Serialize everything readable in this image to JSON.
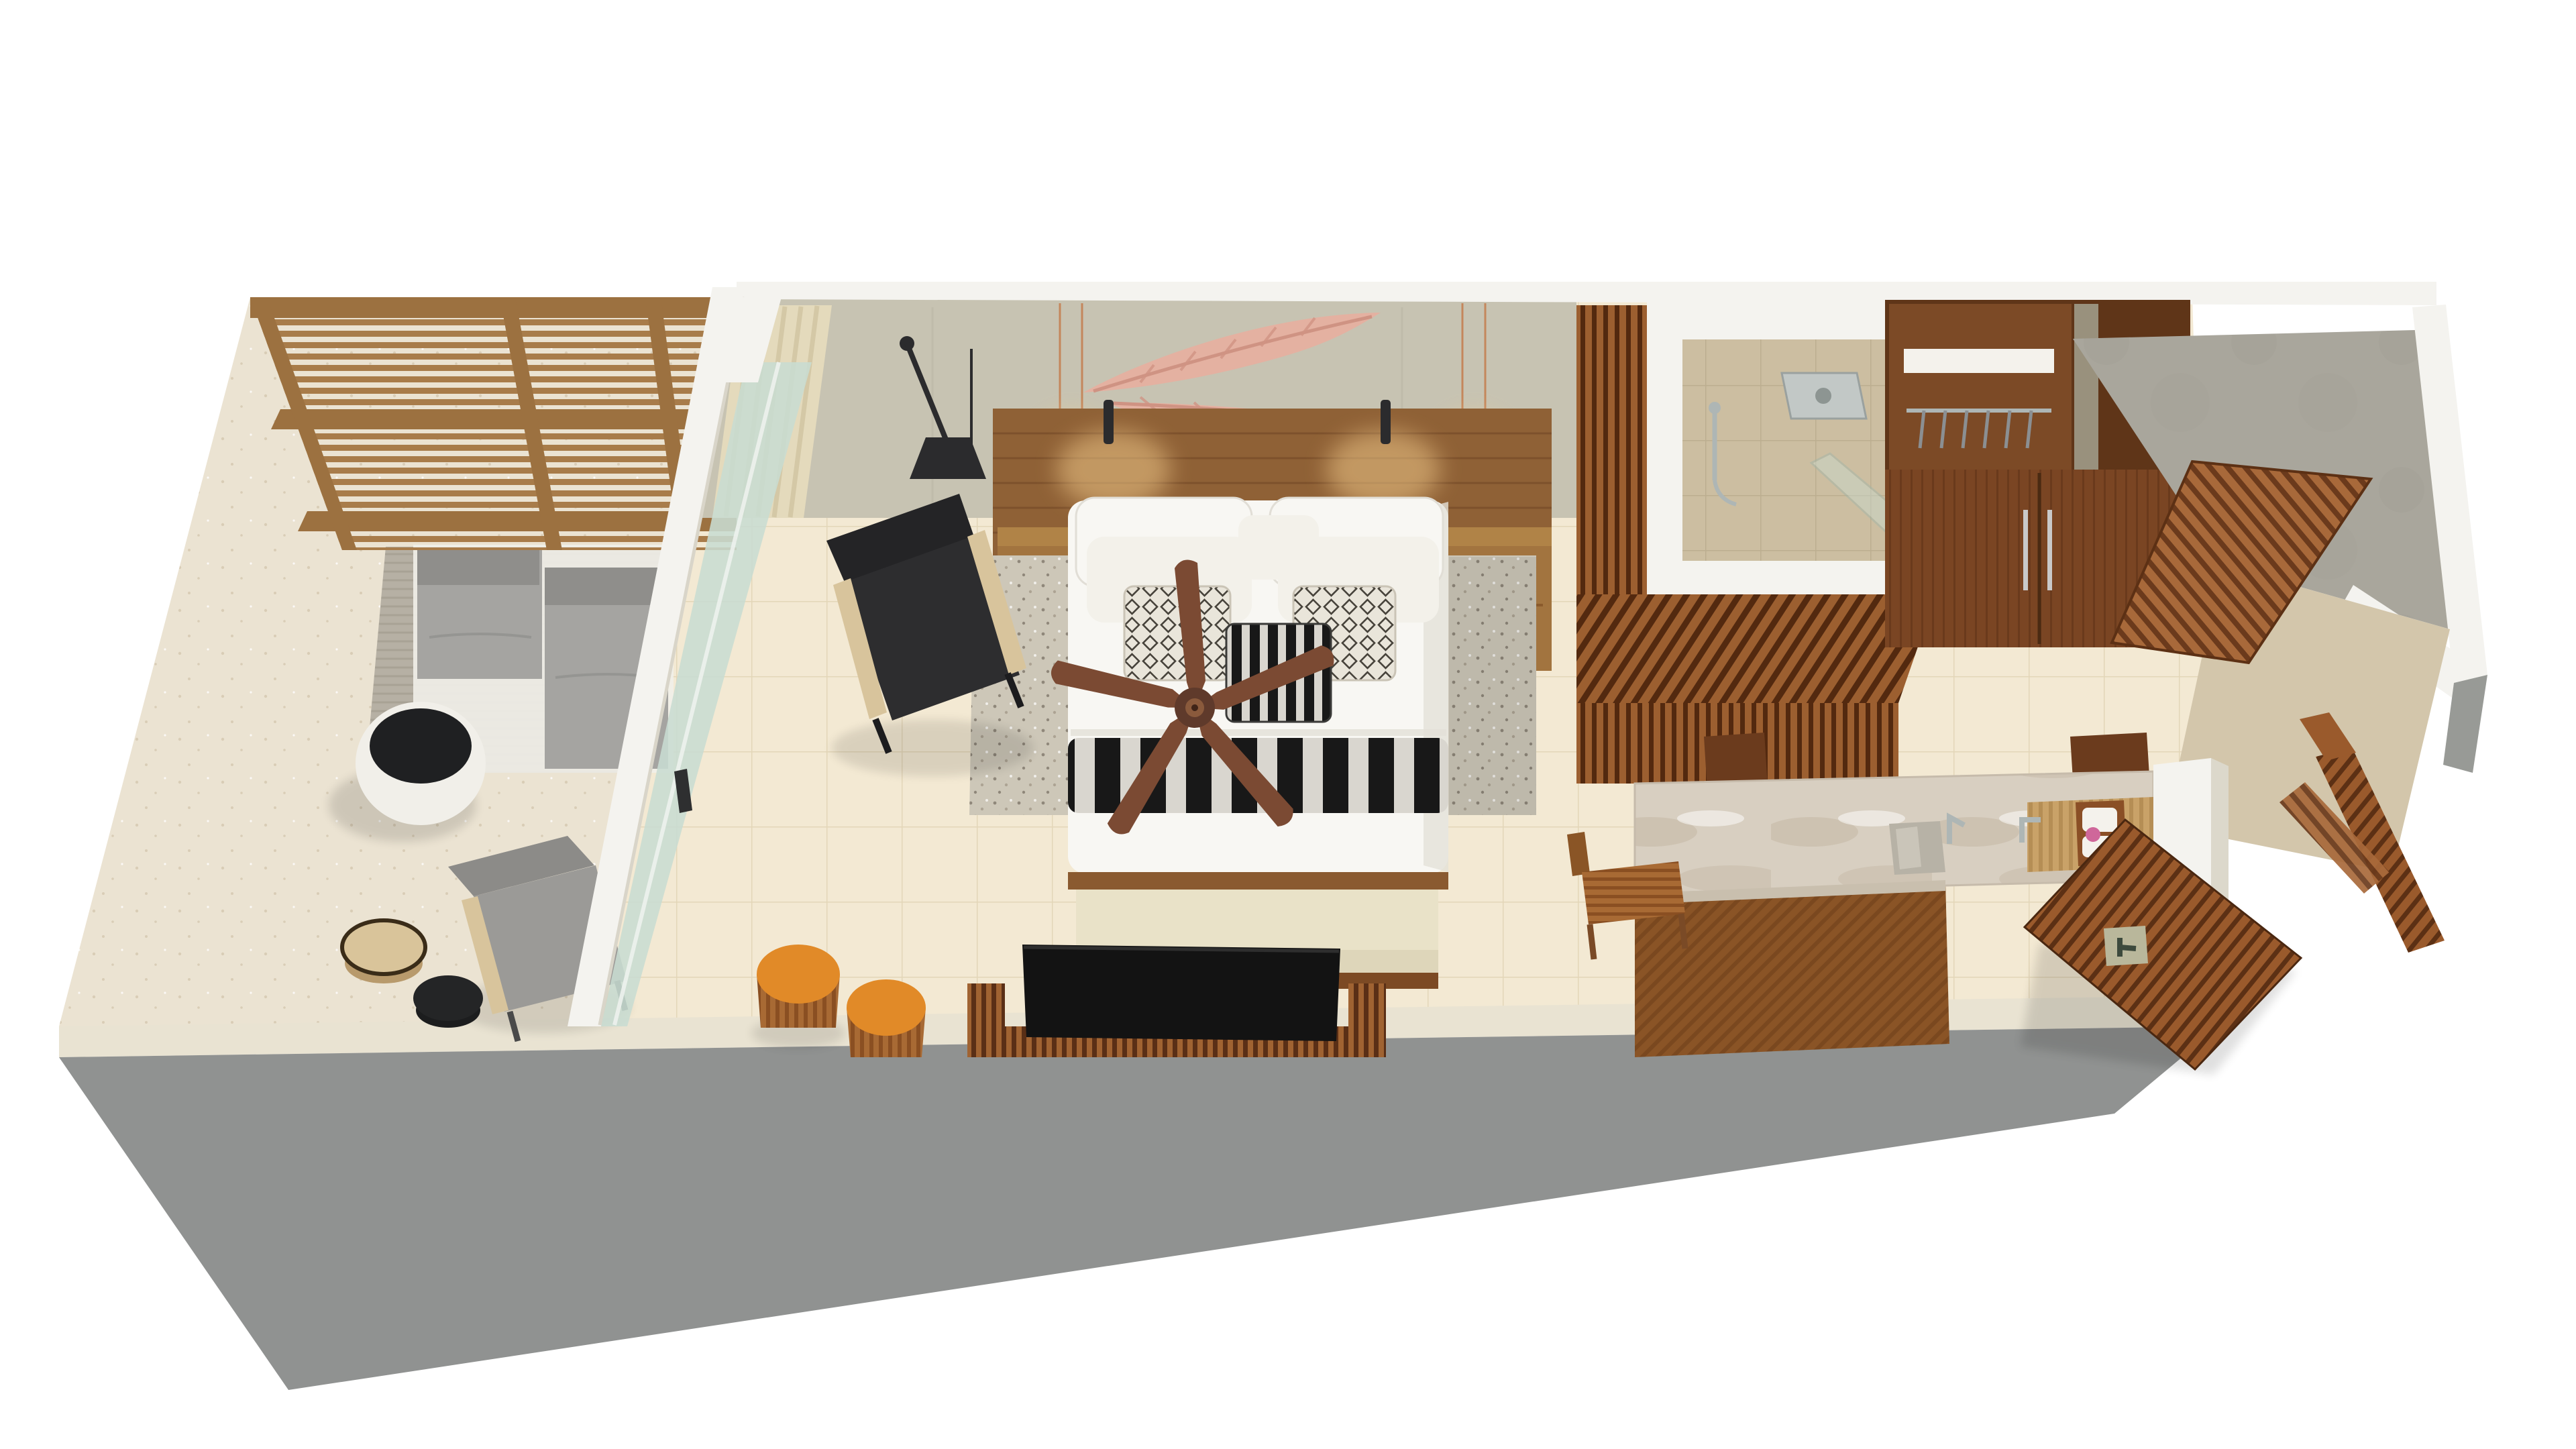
{
  "scene": {
    "kind": "isometric-3d-floor-plan-render",
    "rooms": {
      "terrace": [
        "pergola-roof",
        "lounge-daybed",
        "terrace-rug",
        "round-planter-table",
        "outdoor-armchair",
        "side-table-wood",
        "side-table-black",
        "sliding-glass-door"
      ],
      "bedroom": [
        "feather-wall-art",
        "swing-arm-wall-lamp",
        "curtain",
        "wood-headboard",
        "nightstand-left",
        "nightstand-right",
        "wall-sconces",
        "copper-pendant-lights",
        "double-bed",
        "patterned-cushions",
        "striped-throw",
        "foot-bench",
        "area-rug",
        "ceiling-fan",
        "lounge-chair",
        "orange-drum-stools",
        "tv",
        "tv-console"
      ],
      "bathroom": [
        "wood-slat-partition",
        "walk-in-shower",
        "rain-shower-head",
        "hand-shower",
        "glass-screen",
        "wardrobe",
        "walk-in-closet",
        "clothes-rail-with-hangers",
        "vanity-counter",
        "marble-countertop",
        "vessel-sink",
        "faucet",
        "towel-tray",
        "teak-stool",
        "wood-cabinets"
      ],
      "entry": [
        "concrete-patio",
        "wood-slat-screen",
        "entry-door",
        "door-handle",
        "wood-beam",
        "tan-floor"
      ]
    }
  },
  "colors": {
    "page_bg": "#ffffff",
    "outer_wall_gray": "#909291",
    "outer_wall_gray2": "#989a96",
    "outer_wall_top": "#e9e3d2",
    "terrace_floor": "#ebe3d2",
    "terrace_speck": "#d9cdb6",
    "terrace_rug": "#b6b0a4",
    "terrace_rug_line": "#a8a295",
    "daybed_gray": "#a5a4a1",
    "daybed_dark": "#8f8e8b",
    "planter_white": "#f1efe9",
    "planter_top": "#1f2022",
    "armchair_gray": "#9b9a97",
    "armchair_back": "#8c8b88",
    "side_table_wood": "#d9c49a",
    "side_table_wood_dark": "#b89a6c",
    "side_table_black": "#242526",
    "pergola_wood": "#a87c4a",
    "pergola_beam": "#9c7140",
    "wall_white": "#f4f3ef",
    "wall_shadow": "#d9d5c9",
    "glass_green": "#c8dcd1",
    "glass_line": "#eef2ee",
    "bedroom_wall": "#c7c3b2",
    "wall_seam": "#bdb8a8",
    "art_pink": "#e4b1a1",
    "art_pink_dark": "#cf9383",
    "lamp_black": "#2b2b2d",
    "curtain_cream": "#e4dabc",
    "curtain_shade": "#cfc3a0",
    "headboard_wood": "#8f6136",
    "headboard_line": "#7a4f2a",
    "nightstand_wood": "#a2743f",
    "nightstand_top": "#b08347",
    "pendant_copper": "#c4875c",
    "glow_warm": "#f6cf8e",
    "bed_white": "#f8f7f3",
    "bed_shadow": "#e4e1d8",
    "pillow_white": "#f3f1ea",
    "cushion_bg": "#e9e5da",
    "cushion_fg": "#46423a",
    "stripe_black": "#181818",
    "stripe_light": "#d9d6cf",
    "bench_cream": "#e9e2c8",
    "bench_front": "#ded6ba",
    "bench_wood": "#7c4a24",
    "rug_base": "#cdc7b8",
    "rug_dot": "#8f877a",
    "rug_dot2": "#aca393",
    "fan_wood": "#7b4a33",
    "fan_edge": "#5f3a28",
    "fan_hub": "#5f3a2b",
    "fan_hub2": "#8a5a3c",
    "chair_black": "#2d2d2f",
    "chair_back": "#242426",
    "chair_arm_wood": "#d8c49c",
    "stool_orange": "#e18a28",
    "stool_rim": "#b5651d",
    "stool_wood": "#a86a34",
    "stool_wood_dark": "#8a4f22",
    "tv_black": "#131313",
    "console_wood": "#a06332",
    "console_wood_dark": "#5a2f16",
    "interior_floor": "#f3e9d3",
    "tile_line": "#e3d6b8",
    "slat_wood": "#9c5f30",
    "slat_gap": "#53290f",
    "shower_floor": "#ccbea1",
    "shower_tile_line": "#bcae90",
    "chrome": "#aeb6b5",
    "chrome_dark": "#8d9592",
    "wardrobe_wood": "#5f3518",
    "wardrobe_door": "#7a4523",
    "wardrobe_grain": "#6a3a1c",
    "closet_wood": "#7c4a26",
    "concrete": "#a9a69c",
    "concrete_spot": "#9f9c92",
    "tan_floor": "#d3c6ab",
    "marble": "#d8cfc1",
    "marble_vein": "#bfb29e",
    "marble_edge": "#c9bfae",
    "vanity_wood": "#8a5426",
    "vanity_wood_dark": "#7a481f",
    "deck_wood": "#c9a268",
    "deck_wood_dark": "#b58e55",
    "tray_wood": "#8a4f26",
    "towel_white": "#f4f2ec",
    "accent_pink": "#cf679a",
    "sink_stone": "#b7b2a6",
    "sink_stone_light": "#cac5b9",
    "door_wood": "#9a5a2c",
    "door_wood_dark": "#5c3014",
    "handle_plate": "#b9b79b",
    "handle_metal": "#3d4a3d",
    "shadow": "#000000"
  }
}
